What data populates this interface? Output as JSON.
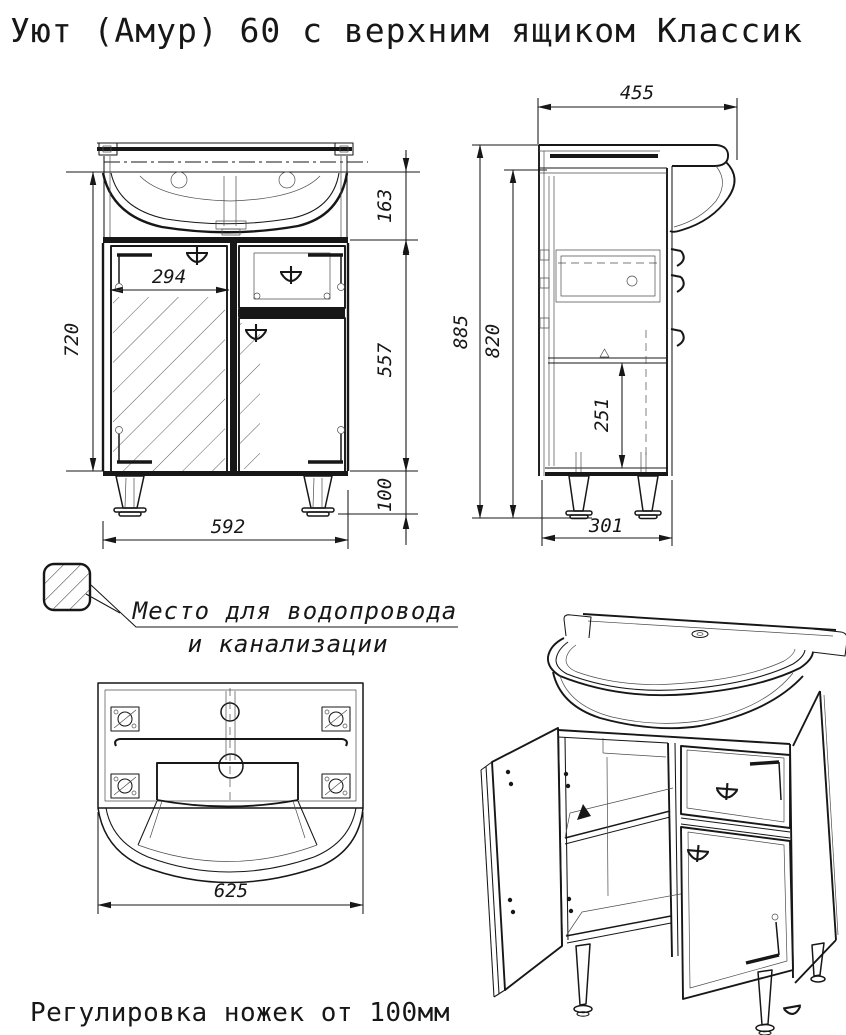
{
  "page": {
    "title": "Уют (Амур) 60 с верхним ящиком Классик",
    "footer": "Регулировка ножек от 100мм"
  },
  "note": {
    "line1": "Место для водопровода",
    "line2": "и канализации"
  },
  "dimensions": {
    "front": {
      "sink_height": "163",
      "door_width": "294",
      "cabinet_height": "720",
      "lower_height": "557",
      "leg_height": "100",
      "width": "592"
    },
    "side": {
      "depth": "455",
      "total_height": "885",
      "body_height": "820",
      "shelf_height": "251",
      "bottom_depth": "301"
    },
    "top": {
      "width": "625"
    }
  }
}
